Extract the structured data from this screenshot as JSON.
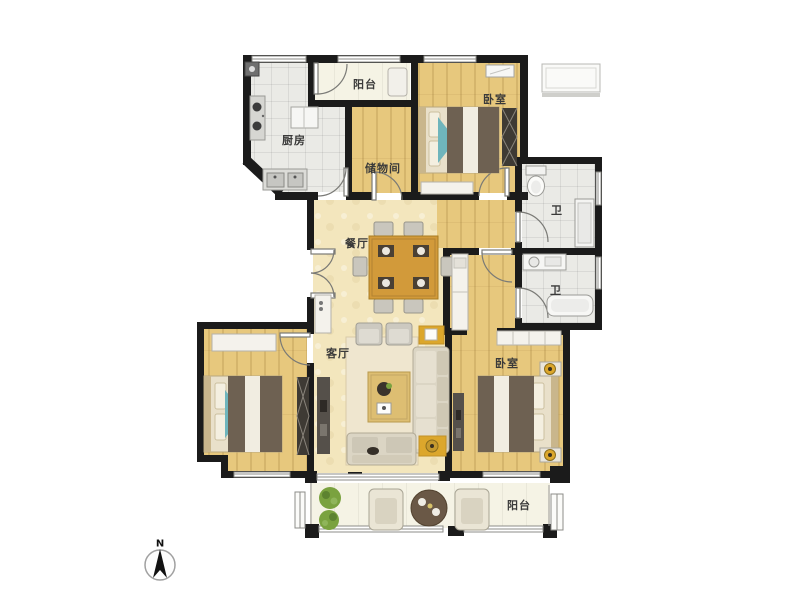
{
  "floorplan": {
    "rooms": [
      {
        "id": "balcony-top",
        "label": "阳台"
      },
      {
        "id": "kitchen",
        "label": "厨房"
      },
      {
        "id": "storage-room",
        "label": "储物间"
      },
      {
        "id": "bedroom-top-right",
        "label": "卧室"
      },
      {
        "id": "bathroom-upper",
        "label": "卫"
      },
      {
        "id": "bathroom-lower",
        "label": "卫"
      },
      {
        "id": "dining-room",
        "label": "餐厅"
      },
      {
        "id": "living-room",
        "label": "客厅"
      },
      {
        "id": "bedroom-bottom-right",
        "label": "卧室"
      },
      {
        "id": "balcony-bottom",
        "label": "阳台"
      }
    ],
    "compass": {
      "north_label": "N"
    },
    "colors": {
      "wall": "#1b1b1b",
      "wood": "#e7c87d",
      "cream": "#f3e6bd",
      "tile": "#eaeae6",
      "balcony": "#f5f3e5",
      "teal": "#6fb5bc",
      "gold": "#dca72c",
      "plant": "#7aa23f",
      "blanket": "#6e6152",
      "table_wood": "#d29a3a",
      "furniture": "#dbd5c4"
    }
  }
}
